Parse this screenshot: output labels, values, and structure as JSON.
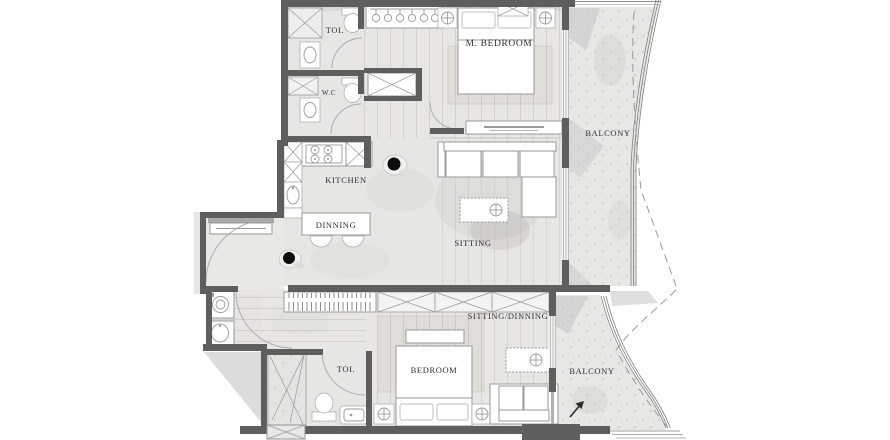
{
  "plan": {
    "title": "Two-bedroom apartment floor plan",
    "rooms": {
      "toilet_top": "TOI.",
      "wc": "W.C",
      "master_bedroom": "M. BEDROOM",
      "kitchen": "KITCHEN",
      "dinning": "DINNING",
      "sitting": "SITTING",
      "balcony_top": "BALCONY",
      "sitting_dinning": "SITTING/DINNING",
      "toilet_bottom": "TOI.",
      "bedroom": "BEDROOM",
      "balcony_bottom": "BALCONY"
    },
    "palette": {
      "wall": "#5e5e5e",
      "wall_light": "#8f8f8f",
      "floor": "#e8e6e3",
      "floor_wood": "#e2dfdb",
      "balcony_floor": "#e9e7e4",
      "furniture_fill": "#ffffff",
      "furniture_line": "#9a9a9a",
      "shadow": "#c7c7c7",
      "label": "#2f2f2f",
      "background": "#ffffff"
    }
  }
}
